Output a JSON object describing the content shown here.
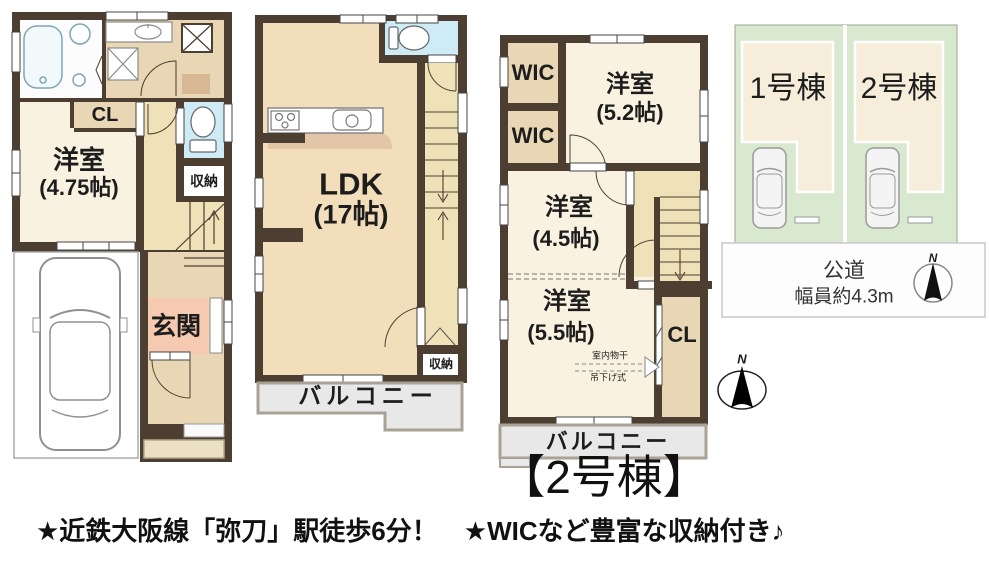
{
  "title": "【2号棟】",
  "catchphrase": "★近鉄大阪線「弥刀」駅徒歩6分！　★WICなど豊富な収納付き♪",
  "floor1": {
    "room_label": "洋室",
    "room_size": "(4.75帖)",
    "closet": "CL",
    "storage": "収納",
    "entrance": "玄関"
  },
  "floor2": {
    "ldk": "LDK",
    "ldk_size": "(17帖)",
    "storage": "収納",
    "balcony": "バルコニー"
  },
  "floor3": {
    "wic_a": "WIC",
    "wic_b": "WIC",
    "room1": "洋室",
    "room1_size": "(5.2帖)",
    "room2": "洋室",
    "room2_size": "(4.5帖)",
    "room3": "洋室",
    "room3_size": "(5.5帖)",
    "closet": "CL",
    "drying1": "室内物干",
    "drying2": "吊下げ式",
    "balcony": "バルコニー"
  },
  "site": {
    "lot1": "1号棟",
    "lot2": "2号棟",
    "road1": "公道",
    "road2": "幅員約4.3m",
    "north": "N"
  },
  "colors": {
    "wall": "#4c3e30",
    "room_cream": "#f9f2e1",
    "room_tan": "#e9d6b4",
    "corridor_yellow": "#efe2b8",
    "ldk_peach": "#f2debb",
    "entrance_pink": "#f6cab0",
    "toilet_blue": "#cfecf6",
    "balcony_gray": "#e8e8e8",
    "site_green": "#d9e9cf",
    "footprint_cream": "#f6eeda",
    "kitchen_band": "#e3c5a8"
  }
}
